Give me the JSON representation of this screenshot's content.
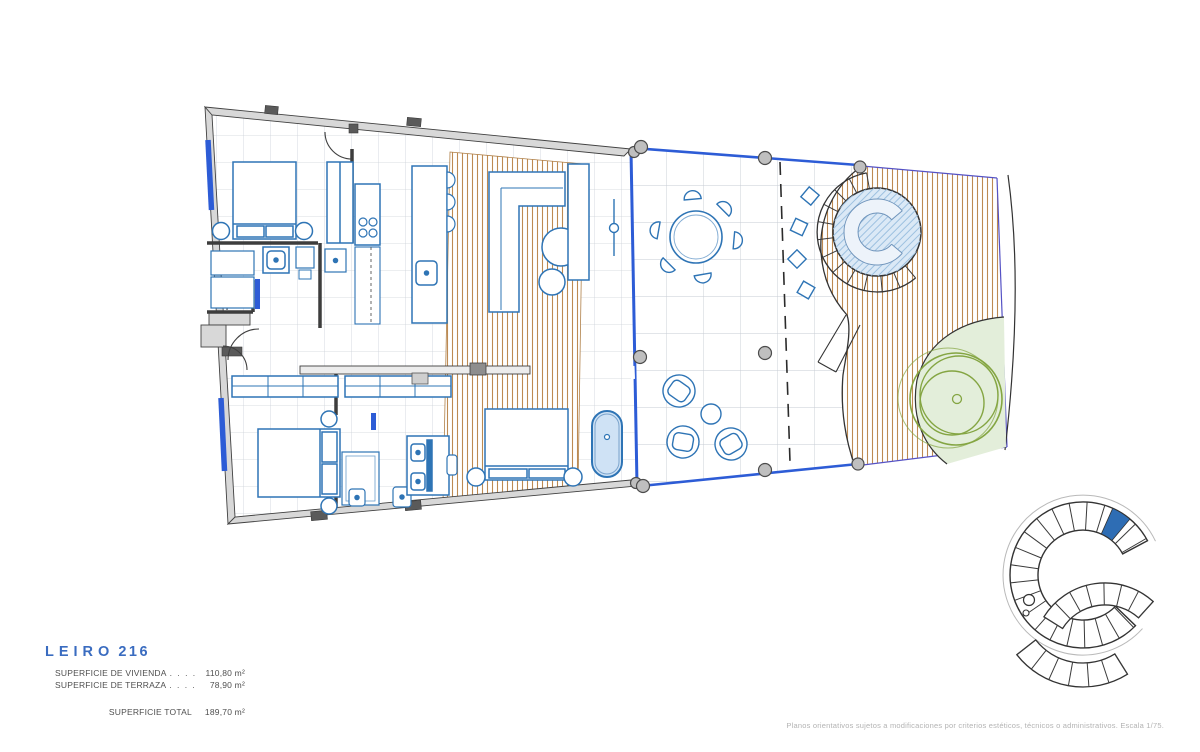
{
  "header": {
    "project_name": "LEIRO",
    "unit_number": "216"
  },
  "summary": {
    "rows": [
      {
        "label": "SUPERFICIE DE VIVIENDA",
        "leader": ". . . . . . . . .",
        "value": "110,80 m²"
      },
      {
        "label": "SUPERFICIE DE TERRAZA",
        "leader": ". . . . . . . . .",
        "value": "78,90 m²"
      }
    ],
    "total_label": "SUPERFICIE TOTAL",
    "total_value": "189,70 m²"
  },
  "footer": {
    "disclaimer": "Planos orientativos sujetos a modificaciones por criterios estéticos, técnicos o administrativos. Escala 1/75."
  },
  "colors": {
    "furniture_blue": "#2e74b5",
    "glass_blue": "#2d5cd6",
    "deck_tan": "#bd8a52",
    "wall_gray": "#d8d8d8",
    "outline_dark": "#3f3f3f",
    "garden_green_stroke": "#84a542",
    "garden_green_fill": "#e3eeda",
    "water_fill": "#dbe9f6",
    "key_highlight_blue": "#2e6db4",
    "title_blue": "#3a6cc0"
  }
}
